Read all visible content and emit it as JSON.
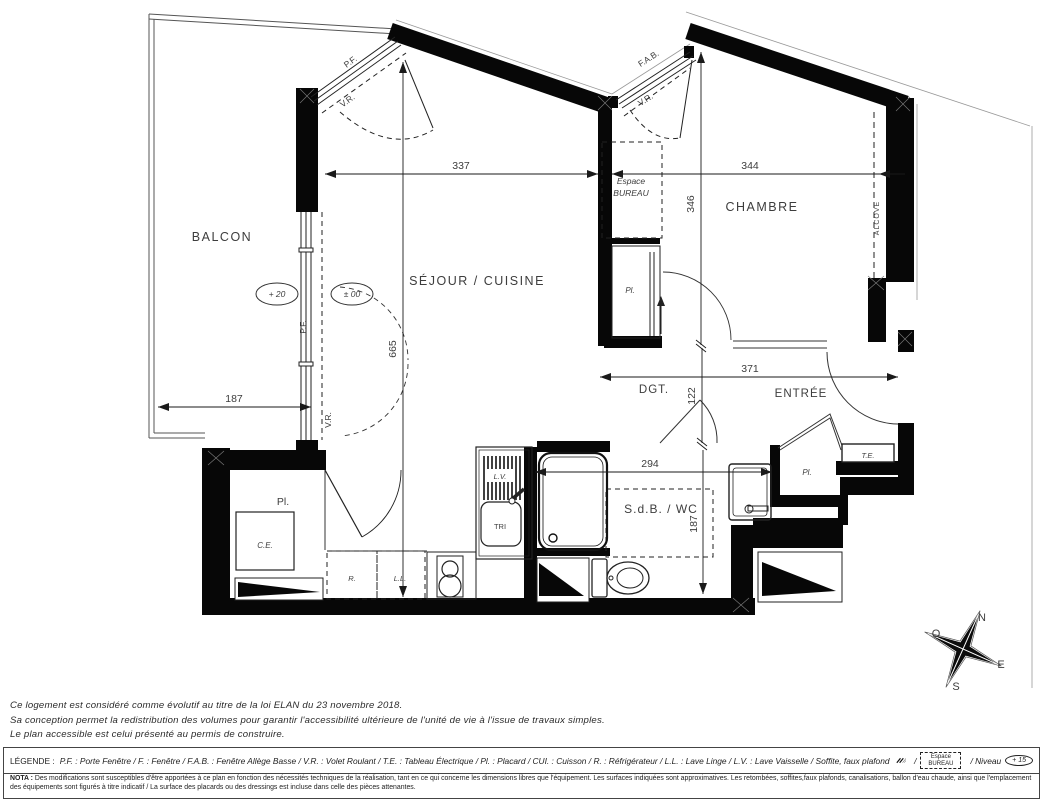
{
  "plan": {
    "rooms": {
      "balcon": "BALCON",
      "sejour_cuisine": "SÉJOUR / CUISINE",
      "chambre": "CHAMBRE",
      "sdb_wc": "S.d.B. / WC",
      "entree": "ENTRÉE",
      "dgt": "DGT.",
      "alcove": "ALCOVE",
      "espace_line1": "Espace",
      "espace_line2": "BUREAU"
    },
    "labels": {
      "pf_angled": "P.F.",
      "vr_angled": "V.R.",
      "fab": "F.A.B.",
      "vr_fab": "V.R.",
      "pf_left": "P.F.",
      "vr_left": "V.R.",
      "pl_chambre": "Pl.",
      "pl_entree": "Pl.",
      "pl_cellier": "Pl.",
      "ce": "C.E.",
      "te": "T.E.",
      "lv": "L.V.",
      "tri": "TRI",
      "refrigerateur": "R.",
      "lave_linge": "L.L."
    },
    "dims": {
      "sejour_w": "337",
      "chambre_w": "344",
      "chambre_h": "346",
      "sejour_h": "665",
      "balcon_w": "187",
      "entree_w": "371",
      "dgt_h": "122",
      "sdb_w": "294",
      "sdb_h": "187"
    },
    "levels": {
      "balcon": "+ 20",
      "sejour": "± 00"
    },
    "compass": {
      "n": "N",
      "e": "E",
      "s": "S",
      "o": "O"
    }
  },
  "notes": {
    "line1": "Ce logement est considéré comme évolutif au titre de la loi ELAN du 23 novembre 2018.",
    "line2": "Sa conception permet la redistribution des volumes pour garantir l'accessibilité ultérieure de l'unité de vie à l'issue de travaux simples.",
    "line3": "Le plan accessible est celui présenté au permis de construire."
  },
  "legend": {
    "label": "LÉGENDE :",
    "items": "P.F. : Porte Fenêtre  /  F. : Fenêtre  /  F.A.B. : Fenêtre Allège Basse  /  V.R. : Volet Roulant  /  T.E. : Tableau Électrique  /  Pl. : Placard  /  CUI. : Cuisson  /  R. : Réfrigérateur  /  L.L. : Lave Linge  /  L.V. : Lave Vaisselle  /  Soffite, faux plafond",
    "sep": "/",
    "espace_line1": "Espace",
    "espace_line2": "BUREAU",
    "niveau_label": "/  Niveau",
    "niveau_value": "+ 15"
  },
  "nota": {
    "label": "NOTA :",
    "text": "Des modifications sont susceptibles d'être apportées à ce plan en fonction des nécessités techniques de la réalisation, tant en ce qui concerne les dimensions libres que l'équipement. Les surfaces indiquées sont approximatives. Les retombées, soffites,faux plafonds, canalisations, ballon d'eau chaude, ainsi que l'emplacement des équipements sont figurés à titre indicatif / La surface des placards ou des dressings est incluse dans celle des pièces attenantes."
  }
}
